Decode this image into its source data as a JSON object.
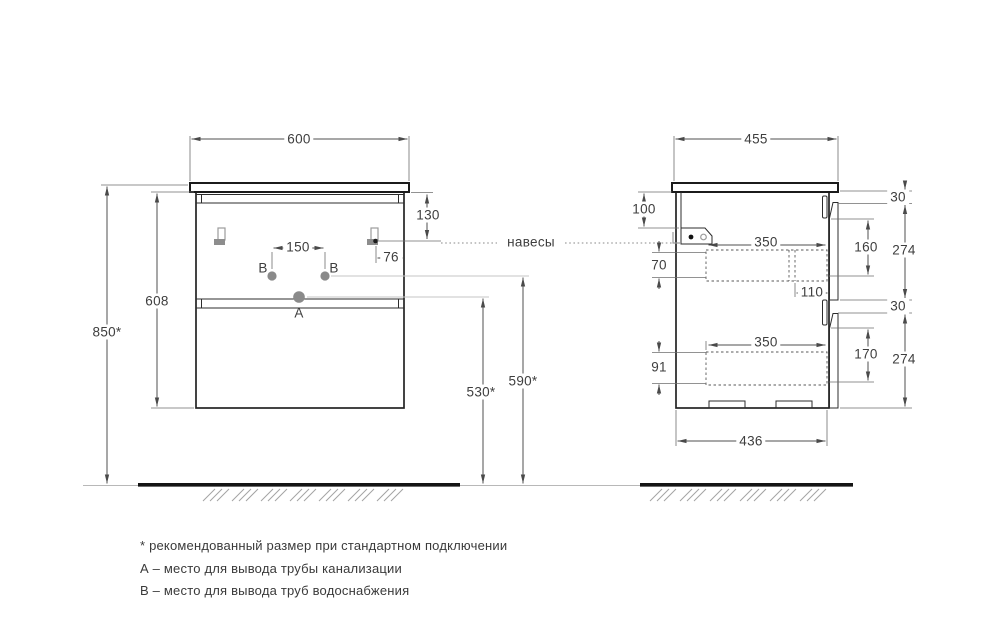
{
  "front_view": {
    "dimensions": {
      "top_width": "600",
      "hanger_top_offset": "130",
      "hanger_side_offset": "76",
      "outlet_spacing": "150",
      "body_height": "608",
      "top_to_floor": "850*",
      "drain_outlet_height": "530*",
      "water_outlet_height": "590*"
    },
    "point_labels": {
      "drain": "A",
      "water_left": "B",
      "water_right": "B"
    }
  },
  "side_view": {
    "dimensions": {
      "top_depth": "455",
      "hanger_top_offset": "100",
      "top_gap": "30",
      "drawer1_depth": "350",
      "drawer1_front_inner": "160",
      "drawer1_front": "274",
      "drawer1_box_side": "70",
      "siphon_offset": "110",
      "middle_gap": "30",
      "drawer2_box_side": "91",
      "drawer2_depth": "350",
      "drawer2_front_inner": "170",
      "drawer2_front": "274",
      "bottom_depth": "436"
    }
  },
  "callouts": {
    "hangers": "навесы"
  },
  "footnotes": [
    "* рекомендованный размер при стандартном подключении",
    "А – место для вывода трубы канализации",
    "В – место для вывода труб водоснабжения"
  ]
}
